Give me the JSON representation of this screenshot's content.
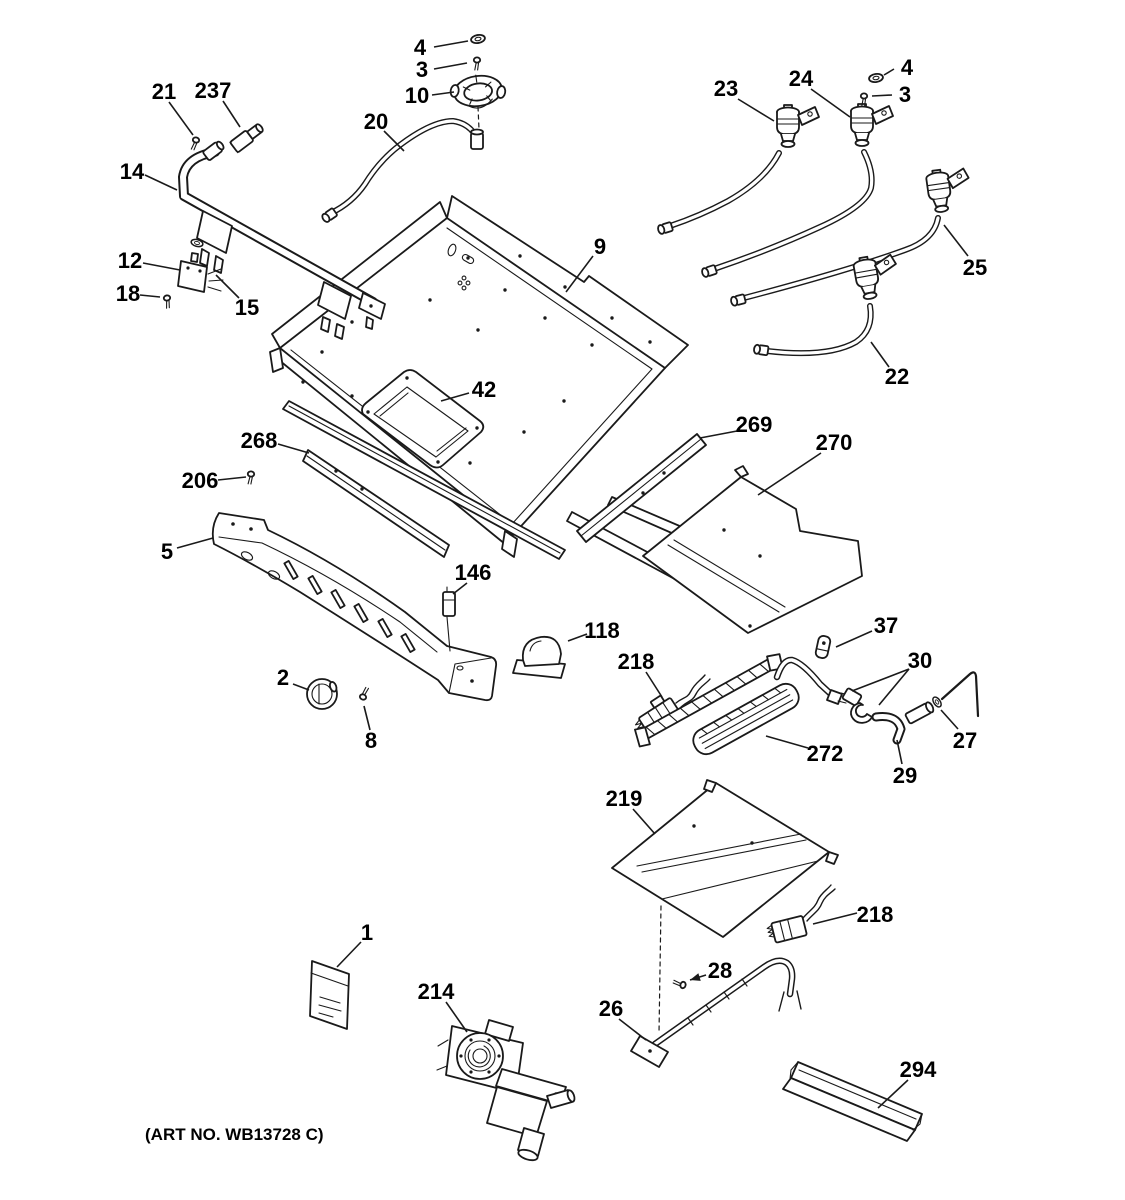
{
  "title": "Gas burner parts exploded diagram",
  "footer": {
    "art_no": "(ART NO. WB13728 C)"
  },
  "colors": {
    "ink": "#1a1a1a",
    "paper": "#ffffff"
  },
  "diagram": {
    "callouts": [
      {
        "t": "4",
        "x": 420,
        "y": 47,
        "l": [
          [
            434,
            47,
            468,
            41
          ]
        ]
      },
      {
        "t": "3",
        "x": 422,
        "y": 69,
        "l": [
          [
            434,
            69,
            467,
            63
          ]
        ]
      },
      {
        "t": "10",
        "x": 417,
        "y": 95,
        "l": [
          [
            432,
            95,
            454,
            92
          ]
        ]
      },
      {
        "t": "20",
        "x": 376,
        "y": 121,
        "l": [
          [
            384,
            131,
            404,
            151
          ]
        ]
      },
      {
        "t": "21",
        "x": 164,
        "y": 91,
        "l": [
          [
            169,
            102,
            193,
            135
          ]
        ]
      },
      {
        "t": "237",
        "x": 213,
        "y": 90,
        "l": [
          [
            223,
            101,
            240,
            127
          ]
        ]
      },
      {
        "t": "14",
        "x": 132,
        "y": 171,
        "l": [
          [
            145,
            175,
            177,
            190
          ]
        ]
      },
      {
        "t": "12",
        "x": 130,
        "y": 260,
        "l": [
          [
            143,
            263,
            180,
            270
          ]
        ]
      },
      {
        "t": "18",
        "x": 128,
        "y": 293,
        "l": [
          [
            140,
            295,
            160,
            297
          ]
        ]
      },
      {
        "t": "15",
        "x": 247,
        "y": 307,
        "l": [
          [
            239,
            298,
            216,
            275
          ]
        ]
      },
      {
        "t": "9",
        "x": 600,
        "y": 246,
        "l": [
          [
            593,
            256,
            566,
            292
          ]
        ]
      },
      {
        "t": "23",
        "x": 726,
        "y": 88,
        "l": [
          [
            738,
            99,
            774,
            121
          ]
        ]
      },
      {
        "t": "24",
        "x": 801,
        "y": 78,
        "l": [
          [
            811,
            89,
            850,
            117
          ]
        ]
      },
      {
        "t": "4",
        "x": 907,
        "y": 67,
        "l": [
          [
            894,
            69,
            884,
            75
          ]
        ]
      },
      {
        "t": "3",
        "x": 905,
        "y": 94,
        "l": [
          [
            892,
            95,
            872,
            96
          ]
        ]
      },
      {
        "t": "25",
        "x": 975,
        "y": 267,
        "l": [
          [
            968,
            256,
            944,
            225
          ]
        ]
      },
      {
        "t": "22",
        "x": 897,
        "y": 376,
        "l": [
          [
            889,
            367,
            871,
            342
          ]
        ]
      },
      {
        "t": "42",
        "x": 484,
        "y": 389,
        "l": [
          [
            469,
            393,
            441,
            401
          ]
        ]
      },
      {
        "t": "268",
        "x": 259,
        "y": 440,
        "l": [
          [
            278,
            444,
            309,
            453
          ]
        ]
      },
      {
        "t": "269",
        "x": 754,
        "y": 424,
        "l": [
          [
            737,
            431,
            700,
            438
          ]
        ]
      },
      {
        "t": "270",
        "x": 834,
        "y": 442,
        "l": [
          [
            821,
            453,
            758,
            495
          ]
        ]
      },
      {
        "t": "206",
        "x": 200,
        "y": 480,
        "l": [
          [
            218,
            480,
            246,
            477
          ]
        ]
      },
      {
        "t": "5",
        "x": 167,
        "y": 551,
        "l": [
          [
            177,
            548,
            213,
            538
          ]
        ]
      },
      {
        "t": "146",
        "x": 473,
        "y": 572,
        "l": [
          [
            467,
            583,
            453,
            594
          ]
        ]
      },
      {
        "t": "118",
        "x": 602,
        "y": 630,
        "l": [
          [
            587,
            634,
            568,
            641
          ]
        ]
      },
      {
        "t": "37",
        "x": 886,
        "y": 625,
        "l": [
          [
            872,
            631,
            836,
            647
          ]
        ]
      },
      {
        "t": "218",
        "x": 636,
        "y": 661,
        "l": [
          [
            646,
            672,
            662,
            697
          ]
        ]
      },
      {
        "t": "30",
        "x": 920,
        "y": 660,
        "l": [
          [
            909,
            669,
            852,
            691
          ],
          [
            909,
            669,
            879,
            705
          ]
        ]
      },
      {
        "t": "2",
        "x": 283,
        "y": 677,
        "l": [
          [
            293,
            684,
            309,
            690
          ]
        ]
      },
      {
        "t": "8",
        "x": 371,
        "y": 740,
        "l": [
          [
            370,
            730,
            364,
            706
          ]
        ]
      },
      {
        "t": "272",
        "x": 825,
        "y": 753,
        "l": [
          [
            808,
            748,
            766,
            736
          ]
        ]
      },
      {
        "t": "27",
        "x": 965,
        "y": 740,
        "l": [
          [
            958,
            729,
            941,
            710
          ]
        ]
      },
      {
        "t": "29",
        "x": 905,
        "y": 775,
        "l": [
          [
            902,
            764,
            897,
            740
          ]
        ]
      },
      {
        "t": "219",
        "x": 624,
        "y": 798,
        "l": [
          [
            633,
            809,
            655,
            834
          ]
        ]
      },
      {
        "t": "218",
        "x": 875,
        "y": 914,
        "l": [
          [
            857,
            913,
            813,
            924
          ]
        ]
      },
      {
        "t": "28",
        "x": 720,
        "y": 970,
        "l": [
          [
            706,
            975,
            690,
            980
          ]
        ],
        "a": true
      },
      {
        "t": "26",
        "x": 611,
        "y": 1008,
        "l": [
          [
            619,
            1019,
            646,
            1040
          ]
        ]
      },
      {
        "t": "1",
        "x": 367,
        "y": 932,
        "l": [
          [
            361,
            942,
            337,
            967
          ]
        ]
      },
      {
        "t": "214",
        "x": 436,
        "y": 991,
        "l": [
          [
            446,
            1002,
            467,
            1032
          ]
        ]
      },
      {
        "t": "294",
        "x": 918,
        "y": 1069,
        "l": [
          [
            908,
            1080,
            878,
            1108
          ]
        ]
      }
    ]
  }
}
